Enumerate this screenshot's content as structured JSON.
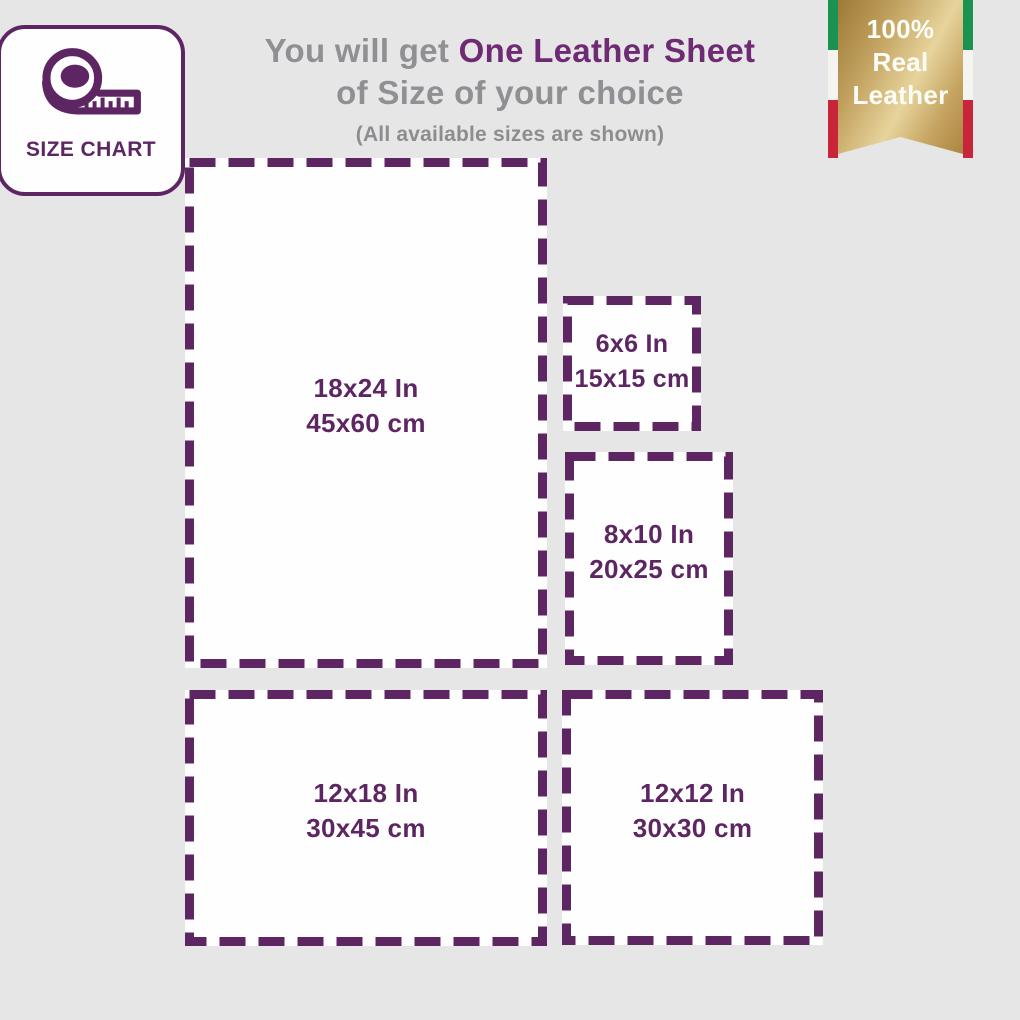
{
  "badge": {
    "label": "SIZE CHART"
  },
  "title": {
    "prefix": "You will get ",
    "highlight": "One Leather Sheet",
    "line2": "of Size of your choice",
    "note": "(All available sizes are shown)"
  },
  "ribbon": {
    "line1": "100%",
    "line2": "Real",
    "line3": "Leather"
  },
  "sizes": [
    {
      "name": "18x24",
      "inches": "18x24 In",
      "cm": "45x60 cm"
    },
    {
      "name": "6x6",
      "inches": "6x6 In",
      "cm": "15x15 cm"
    },
    {
      "name": "8x10",
      "inches": "8x10 In",
      "cm": "20x25 cm"
    },
    {
      "name": "12x18",
      "inches": "12x18 In",
      "cm": "30x45 cm"
    },
    {
      "name": "12x12",
      "inches": "12x12 In",
      "cm": "30x30 cm"
    }
  ],
  "colors": {
    "purple": "#5d2663",
    "title_purple": "#6e2a72",
    "gray_text": "#909094",
    "background": "#e7e6e7",
    "flag_green": "#1a9350",
    "flag_white": "#f5f4f1",
    "flag_red": "#c8243a",
    "gold_dark": "#9c7936",
    "gold_light": "#e7d49c"
  }
}
